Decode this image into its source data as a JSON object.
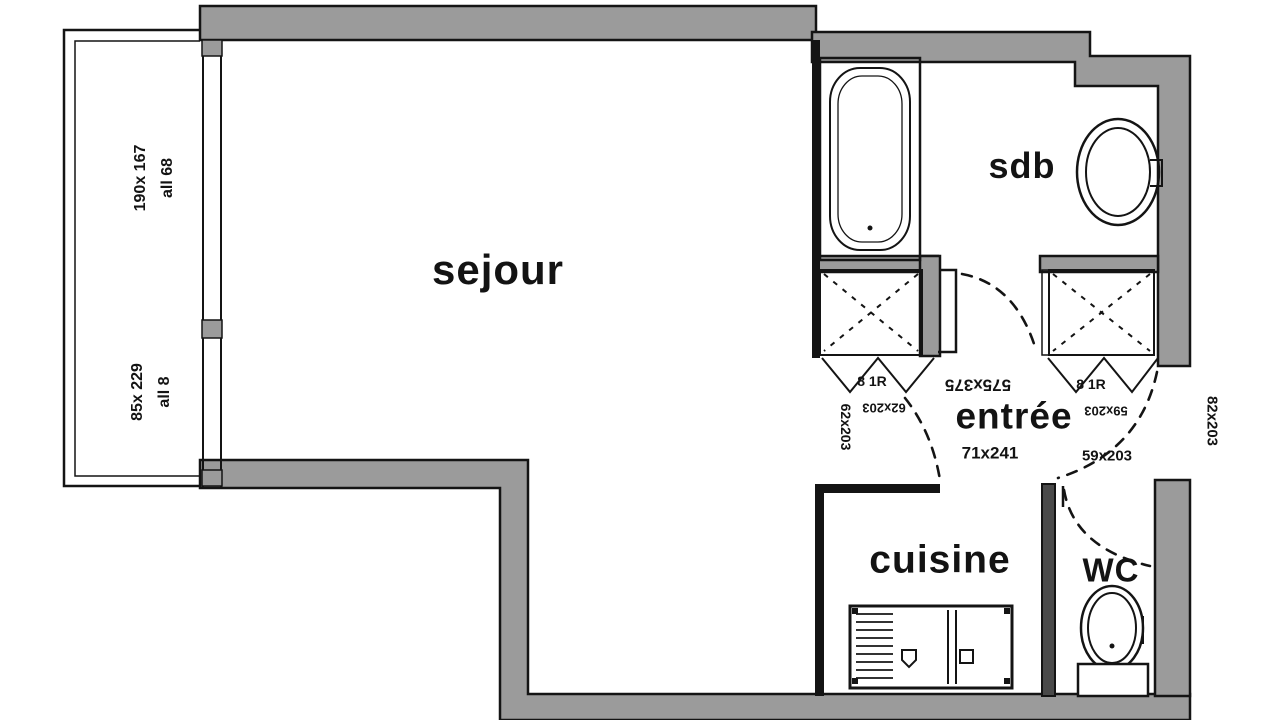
{
  "plan_title": "studio floor plan",
  "rooms": {
    "sejour": "sejour",
    "sdb": "sdb",
    "entree": "entrée",
    "cuisine": "cuisine",
    "wc": "WC"
  },
  "annotations": {
    "balcony_upper_dim": "190x 167",
    "balcony_upper_note": "all 68",
    "balcony_lower_dim": "85x 229",
    "balcony_lower_note": "all 8",
    "entree_dim": "71x241",
    "entry_door_dim": "82x203",
    "sejour_dim_flipped": "575x375",
    "left_closet_door_dim_vertical": "62x203",
    "left_closet_door_dim_flipped": "62x203",
    "left_closet_note": "8 1R",
    "right_closet_door_dim": "59x203",
    "right_closet_door_dim_flipped": "59x203",
    "right_closet_note": "8 1R"
  },
  "colors": {
    "wall_fill": "#9b9b9b",
    "line": "#141414",
    "background": "#ffffff"
  }
}
